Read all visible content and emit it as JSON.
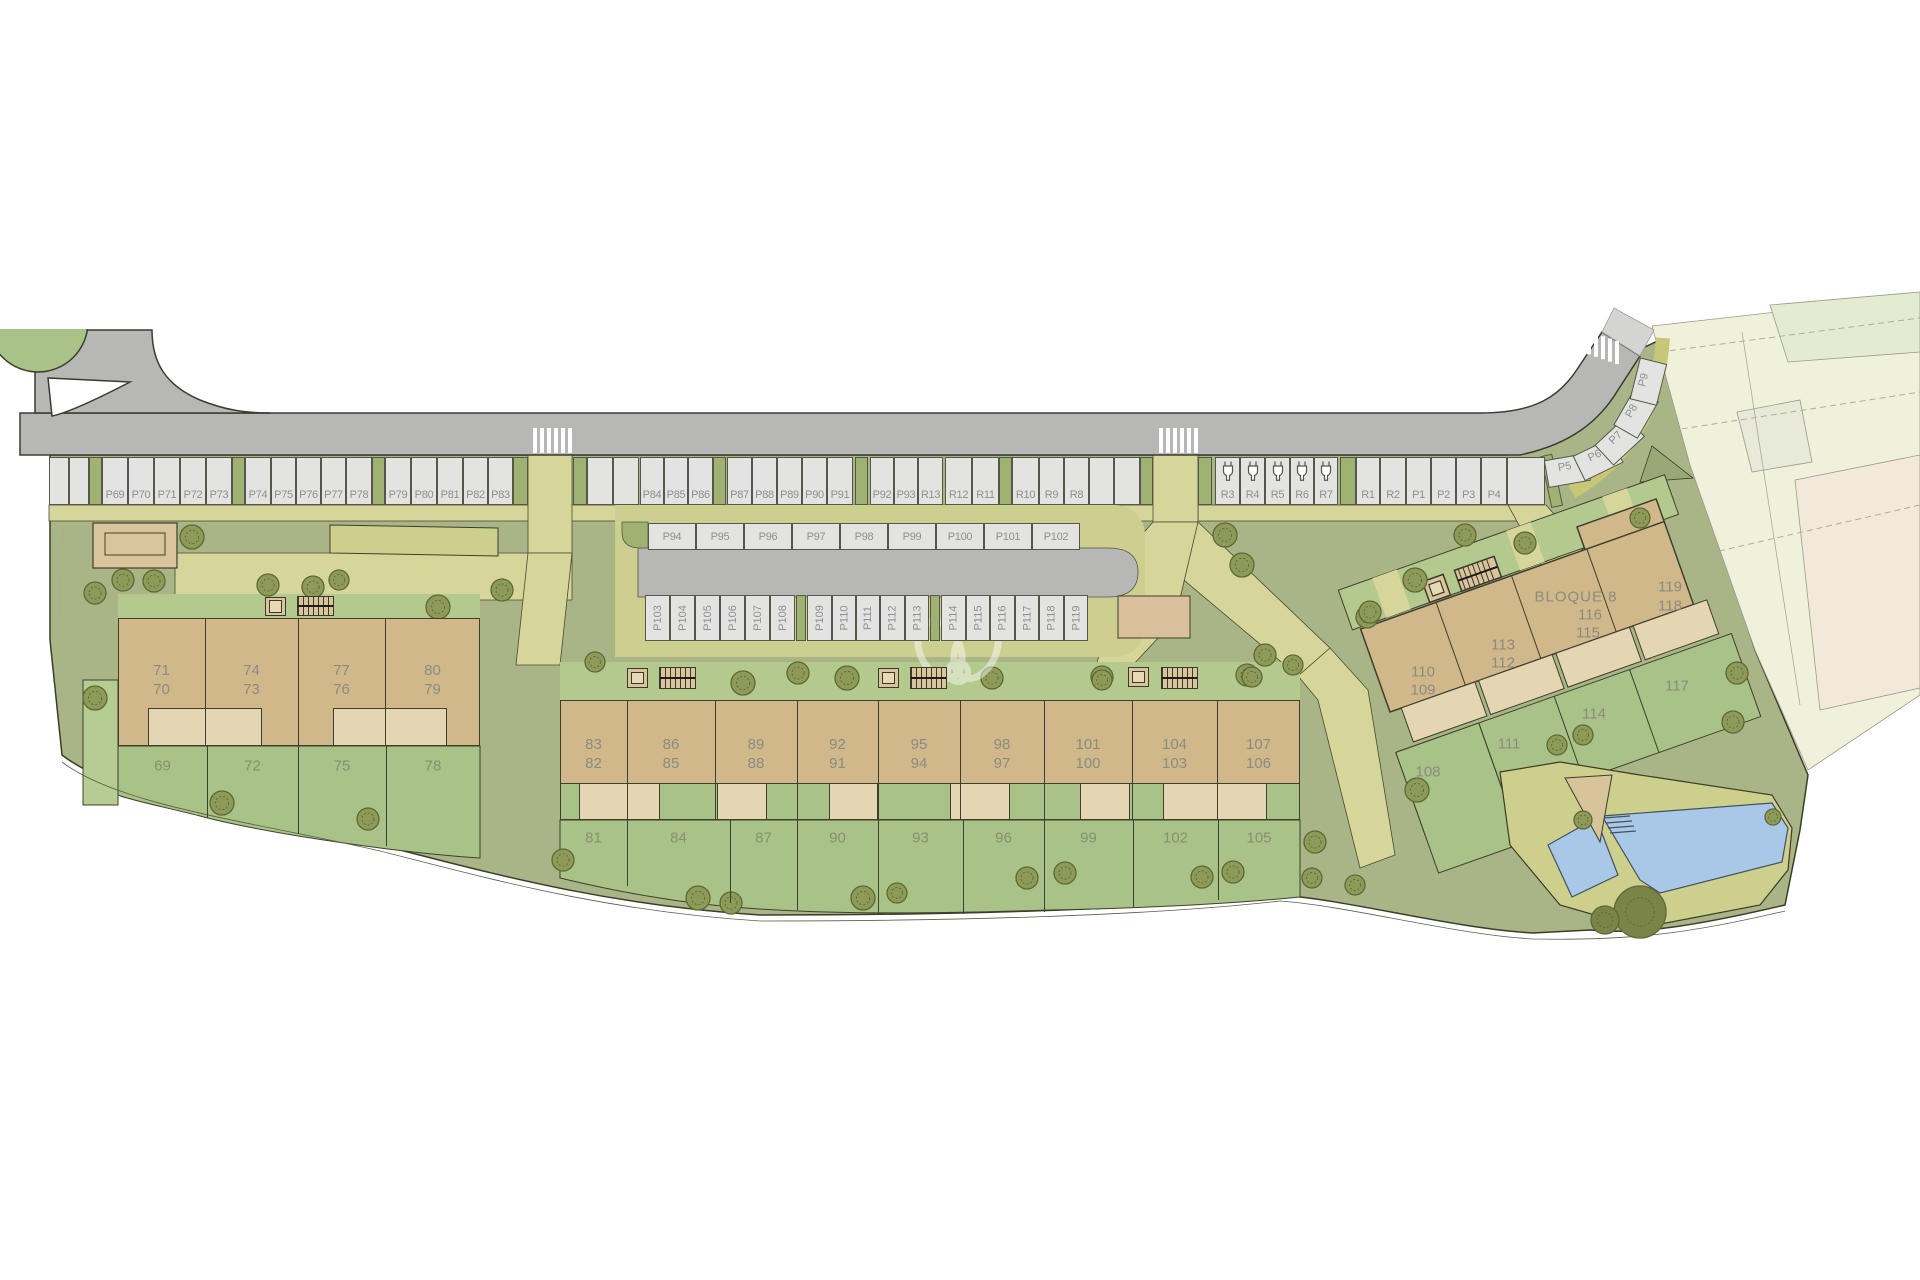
{
  "canvas": {
    "w": 1920,
    "h": 1280
  },
  "colors": {
    "road": "#b7b7b5",
    "stall": "#e3e3e1",
    "stall_border": "#56564a",
    "green_stall": "#9fb271",
    "verge": "#cdcf8c",
    "path": "#d6d69a",
    "lawn": "#a9b586",
    "garden": "#a8c287",
    "garden_light": "#b5cc92",
    "building_tan": "#d0b88b",
    "terrace_beige": "#e4d6b2",
    "pergola": "#d9c49c",
    "pool_water": "#a9c8e8",
    "cadastral": "#f0f1da",
    "cadastral_pink": "#f3e9da",
    "cadastral_green": "#e3ecd0",
    "tree_fill": "#8d9a58",
    "tree_stroke": "#5f6836",
    "outline": "#3f3f2e"
  },
  "parking": {
    "row1": {
      "y": 457,
      "h": 48,
      "segments": [
        {
          "t": "u",
          "x": 49,
          "w": 20
        },
        {
          "t": "u",
          "x": 69,
          "w": 20
        },
        {
          "t": "g",
          "x": 89,
          "w": 13
        },
        {
          "t": "s",
          "l": "P69",
          "x": 102,
          "w": 26
        },
        {
          "t": "s",
          "l": "P70",
          "x": 128,
          "w": 26
        },
        {
          "t": "s",
          "l": "P71",
          "x": 154,
          "w": 26
        },
        {
          "t": "s",
          "l": "P72",
          "x": 180,
          "w": 26
        },
        {
          "t": "s",
          "l": "P73",
          "x": 206,
          "w": 26
        },
        {
          "t": "g",
          "x": 232,
          "w": 13
        },
        {
          "t": "s",
          "l": "P74",
          "x": 245,
          "w": 26
        },
        {
          "t": "s",
          "l": "P75",
          "x": 271,
          "w": 25
        },
        {
          "t": "s",
          "l": "P76",
          "x": 296,
          "w": 25
        },
        {
          "t": "s",
          "l": "P77",
          "x": 321,
          "w": 25
        },
        {
          "t": "s",
          "l": "P78",
          "x": 346,
          "w": 26
        },
        {
          "t": "g",
          "x": 372,
          "w": 13
        },
        {
          "t": "s",
          "l": "P79",
          "x": 385,
          "w": 26
        },
        {
          "t": "s",
          "l": "P80",
          "x": 411,
          "w": 26
        },
        {
          "t": "s",
          "l": "P81",
          "x": 437,
          "w": 26
        },
        {
          "t": "s",
          "l": "P82",
          "x": 463,
          "w": 25
        },
        {
          "t": "s",
          "l": "P83",
          "x": 488,
          "w": 25
        },
        {
          "t": "g",
          "x": 513,
          "w": 15
        },
        {
          "t": "p",
          "x": 528,
          "w": 45
        },
        {
          "t": "g",
          "x": 573,
          "w": 14
        },
        {
          "t": "u",
          "x": 587,
          "w": 26
        },
        {
          "t": "u",
          "x": 613,
          "w": 26
        },
        {
          "t": "s",
          "l": "P84",
          "x": 640,
          "w": 24
        },
        {
          "t": "s",
          "l": "P85",
          "x": 664,
          "w": 24
        },
        {
          "t": "s",
          "l": "P86",
          "x": 688,
          "w": 25
        },
        {
          "t": "g",
          "x": 713,
          "w": 13
        },
        {
          "t": "s",
          "l": "P87",
          "x": 727,
          "w": 25
        },
        {
          "t": "s",
          "l": "P88",
          "x": 752,
          "w": 25
        },
        {
          "t": "s",
          "l": "P89",
          "x": 777,
          "w": 25
        },
        {
          "t": "s",
          "l": "P90",
          "x": 802,
          "w": 25
        },
        {
          "t": "s",
          "l": "P91",
          "x": 827,
          "w": 26
        },
        {
          "t": "g",
          "x": 855,
          "w": 13
        },
        {
          "t": "s",
          "l": "P92",
          "x": 870,
          "w": 24
        },
        {
          "t": "s",
          "l": "P93",
          "x": 894,
          "w": 24
        },
        {
          "t": "s",
          "l": "R13",
          "x": 918,
          "w": 25
        },
        {
          "t": "s",
          "l": "R12",
          "x": 945,
          "w": 27
        },
        {
          "t": "s",
          "l": "R11",
          "x": 972,
          "w": 27
        },
        {
          "t": "g",
          "x": 999,
          "w": 13
        },
        {
          "t": "s",
          "l": "R10",
          "x": 1012,
          "w": 27
        },
        {
          "t": "s",
          "l": "R9",
          "x": 1039,
          "w": 25
        },
        {
          "t": "s",
          "l": "R8",
          "x": 1064,
          "w": 25
        },
        {
          "t": "u",
          "x": 1089,
          "w": 25
        },
        {
          "t": "u",
          "x": 1114,
          "w": 26
        },
        {
          "t": "g",
          "x": 1140,
          "w": 13
        },
        {
          "t": "p",
          "x": 1153,
          "w": 45
        },
        {
          "t": "g",
          "x": 1198,
          "w": 14
        },
        {
          "t": "c",
          "l": "R3",
          "x": 1215,
          "w": 25
        },
        {
          "t": "c",
          "l": "R4",
          "x": 1240,
          "w": 25
        },
        {
          "t": "c",
          "l": "R5",
          "x": 1265,
          "w": 25
        },
        {
          "t": "c",
          "l": "R6",
          "x": 1290,
          "w": 24
        },
        {
          "t": "c",
          "l": "R7",
          "x": 1314,
          "w": 24
        },
        {
          "t": "g",
          "x": 1340,
          "w": 16
        },
        {
          "t": "s",
          "l": "R1",
          "x": 1356,
          "w": 24
        },
        {
          "t": "s",
          "l": "R2",
          "x": 1380,
          "w": 26
        },
        {
          "t": "s",
          "l": "P1",
          "x": 1406,
          "w": 25
        },
        {
          "t": "s",
          "l": "P2",
          "x": 1431,
          "w": 25
        },
        {
          "t": "s",
          "l": "P3",
          "x": 1456,
          "w": 25
        },
        {
          "t": "s",
          "l": "P4",
          "x": 1481,
          "w": 26
        },
        {
          "t": "u",
          "x": 1507,
          "w": 38
        }
      ]
    },
    "row2": {
      "y": 523,
      "h": 27,
      "stalls": [
        {
          "l": "P94",
          "x": 648,
          "w": 48
        },
        {
          "l": "P95",
          "x": 696,
          "w": 48
        },
        {
          "l": "P96",
          "x": 744,
          "w": 48
        },
        {
          "l": "P97",
          "x": 792,
          "w": 48
        },
        {
          "l": "P98",
          "x": 840,
          "w": 48
        },
        {
          "l": "P99",
          "x": 888,
          "w": 48
        },
        {
          "l": "P100",
          "x": 936,
          "w": 48
        },
        {
          "l": "P101",
          "x": 984,
          "w": 48
        },
        {
          "l": "P102",
          "x": 1032,
          "w": 48
        }
      ]
    },
    "row3": {
      "y": 595,
      "h": 46,
      "segments": [
        {
          "t": "s",
          "l": "P103",
          "x": 645,
          "w": 25
        },
        {
          "t": "s",
          "l": "P104",
          "x": 670,
          "w": 25
        },
        {
          "t": "s",
          "l": "P105",
          "x": 695,
          "w": 25
        },
        {
          "t": "s",
          "l": "P106",
          "x": 720,
          "w": 25
        },
        {
          "t": "s",
          "l": "P107",
          "x": 745,
          "w": 25
        },
        {
          "t": "s",
          "l": "P108",
          "x": 770,
          "w": 25
        },
        {
          "t": "g",
          "x": 796,
          "w": 10
        },
        {
          "t": "s",
          "l": "P109",
          "x": 807,
          "w": 25
        },
        {
          "t": "s",
          "l": "P110",
          "x": 832,
          "w": 24
        },
        {
          "t": "s",
          "l": "P111",
          "x": 856,
          "w": 24
        },
        {
          "t": "s",
          "l": "P112",
          "x": 880,
          "w": 25
        },
        {
          "t": "s",
          "l": "P113",
          "x": 905,
          "w": 24
        },
        {
          "t": "g",
          "x": 930,
          "w": 10
        },
        {
          "t": "s",
          "l": "P114",
          "x": 941,
          "w": 25
        },
        {
          "t": "s",
          "l": "P115",
          "x": 966,
          "w": 24
        },
        {
          "t": "s",
          "l": "P116",
          "x": 990,
          "w": 25
        },
        {
          "t": "s",
          "l": "P117",
          "x": 1015,
          "w": 24
        },
        {
          "t": "s",
          "l": "P118",
          "x": 1039,
          "w": 25
        },
        {
          "t": "s",
          "l": "P119",
          "x": 1064,
          "w": 24
        }
      ]
    },
    "curve_stalls": [
      {
        "l": "P5",
        "x": 1567,
        "y": 468,
        "r": -10
      },
      {
        "l": "P6",
        "x": 1597,
        "y": 457,
        "r": -26
      },
      {
        "l": "P7",
        "x": 1618,
        "y": 439,
        "r": -43
      },
      {
        "l": "P8",
        "x": 1634,
        "y": 412,
        "r": -60
      },
      {
        "l": "P9",
        "x": 1646,
        "y": 381,
        "r": -76
      }
    ]
  },
  "blocks": {
    "bloque6": {
      "title": "BLOQUE 6",
      "title_pos": {
        "x": 298,
        "y": 643
      },
      "bounds": [
        118,
        205,
        298,
        385,
        480
      ],
      "y": {
        "top": 618,
        "terrace": 708,
        "bottom": 746
      },
      "units": [
        [
          "71",
          "70"
        ],
        [
          "74",
          "73"
        ],
        [
          "77",
          "76"
        ],
        [
          "80",
          "79"
        ]
      ],
      "unit_y": 680,
      "terraces": [
        [
          148,
          114
        ],
        [
          333,
          114
        ]
      ],
      "gardens": {
        "label_y": 766,
        "bounds": [
          118,
          207,
          298,
          386,
          480
        ],
        "labels": [
          "69",
          "72",
          "75",
          "78"
        ],
        "div_h": [
          72,
          88,
          100
        ]
      }
    },
    "bloque7": {
      "title": "BLOQUE 7",
      "title_pos": {
        "x": 952,
        "y": 721
      },
      "bounds": [
        560,
        627,
        715,
        797,
        878,
        960,
        1044,
        1132,
        1217,
        1300
      ],
      "y": {
        "top": 700,
        "terrace": 783,
        "bottom": 820
      },
      "units": [
        [
          "83",
          "82"
        ],
        [
          "86",
          "85"
        ],
        [
          "89",
          "88"
        ],
        [
          "92",
          "91"
        ],
        [
          "95",
          "94"
        ],
        [
          "98",
          "97"
        ],
        [
          "101",
          "100"
        ],
        [
          "104",
          "103"
        ],
        [
          "107",
          "106"
        ]
      ],
      "unit_y": 754,
      "terraces": [
        [
          579,
          81
        ],
        [
          717,
          50
        ],
        [
          829,
          49
        ],
        [
          950,
          60
        ],
        [
          1080,
          50
        ],
        [
          1163,
          104
        ]
      ],
      "gardens": {
        "label_y": 838,
        "bounds": [
          560,
          627,
          730,
          797,
          878,
          963,
          1044,
          1133,
          1218,
          1300
        ],
        "labels": [
          "81",
          "84",
          "87",
          "90",
          "93",
          "96",
          "99",
          "102",
          "105"
        ],
        "div_h": [
          66,
          83,
          90,
          93,
          94,
          92,
          87,
          80
        ]
      }
    },
    "bloque8": {
      "title": "BLOQUE 8",
      "labels": [
        {
          "t": "BLOQUE 8",
          "x": 1576,
          "y": 597,
          "title": true
        },
        {
          "t": "116",
          "x": 1590,
          "y": 615
        },
        {
          "t": "115",
          "x": 1588,
          "y": 633
        },
        {
          "t": "119",
          "x": 1670,
          "y": 587
        },
        {
          "t": "118",
          "x": 1670,
          "y": 606
        },
        {
          "t": "113",
          "x": 1503,
          "y": 645
        },
        {
          "t": "112",
          "x": 1503,
          "y": 663
        },
        {
          "t": "110",
          "x": 1423,
          "y": 672
        },
        {
          "t": "109",
          "x": 1423,
          "y": 690
        },
        {
          "t": "117",
          "x": 1677,
          "y": 686
        },
        {
          "t": "114",
          "x": 1594,
          "y": 714
        },
        {
          "t": "111",
          "x": 1509,
          "y": 744
        },
        {
          "t": "108",
          "x": 1428,
          "y": 772
        }
      ]
    }
  },
  "icons": {
    "elevators": [
      {
        "x": 265,
        "y": 597,
        "w": 21,
        "h": 19
      },
      {
        "x": 627,
        "y": 668,
        "w": 21,
        "h": 20
      },
      {
        "x": 878,
        "y": 668,
        "w": 21,
        "h": 20
      },
      {
        "x": 1128,
        "y": 667,
        "w": 21,
        "h": 20
      }
    ],
    "stairs": [
      {
        "x": 297,
        "y": 596,
        "w": 37,
        "h": 20
      },
      {
        "x": 659,
        "y": 667,
        "w": 37,
        "h": 22
      },
      {
        "x": 910,
        "y": 667,
        "w": 37,
        "h": 22
      },
      {
        "x": 1161,
        "y": 667,
        "w": 37,
        "h": 22
      }
    ]
  },
  "crosswalks": [
    {
      "x": 533,
      "y": 428,
      "n": 6,
      "dy": 0,
      "h": 25
    },
    {
      "x": 1159,
      "y": 428,
      "n": 6,
      "dy": 0,
      "h": 25
    },
    {
      "x": 1580,
      "y": 329,
      "n": 6,
      "dy": 2.4,
      "h": 23
    }
  ],
  "trees": [
    [
      95,
      593,
      11
    ],
    [
      123,
      580,
      11
    ],
    [
      154,
      581,
      11
    ],
    [
      192,
      537,
      12
    ],
    [
      268,
      585,
      11
    ],
    [
      313,
      587,
      11
    ],
    [
      339,
      580,
      10
    ],
    [
      438,
      607,
      12
    ],
    [
      502,
      590,
      11
    ],
    [
      95,
      698,
      12
    ],
    [
      222,
      803,
      12
    ],
    [
      368,
      819,
      11
    ],
    [
      466,
      476,
      14,
      1
    ],
    [
      595,
      662,
      10
    ],
    [
      743,
      683,
      12
    ],
    [
      798,
      673,
      11
    ],
    [
      847,
      678,
      12
    ],
    [
      992,
      678,
      11
    ],
    [
      1102,
      677,
      11
    ],
    [
      1247,
      675,
      11
    ],
    [
      1293,
      665,
      10
    ],
    [
      563,
      860,
      11
    ],
    [
      698,
      898,
      12
    ],
    [
      731,
      903,
      11
    ],
    [
      863,
      898,
      12
    ],
    [
      897,
      893,
      10
    ],
    [
      1027,
      878,
      11
    ],
    [
      1065,
      873,
      11
    ],
    [
      1202,
      877,
      11
    ],
    [
      1233,
      872,
      11
    ],
    [
      1315,
      842,
      11
    ],
    [
      1312,
      878,
      10
    ],
    [
      1355,
      885,
      10
    ],
    [
      1225,
      535,
      12
    ],
    [
      1242,
      565,
      12
    ],
    [
      1367,
      617,
      11
    ],
    [
      1265,
      655,
      11
    ],
    [
      1252,
      677,
      10
    ],
    [
      1102,
      680,
      10
    ],
    [
      1465,
      535,
      11
    ],
    [
      1525,
      543,
      11
    ],
    [
      1415,
      580,
      12
    ],
    [
      1370,
      612,
      11
    ],
    [
      1640,
      518,
      10
    ],
    [
      1737,
      673,
      11
    ],
    [
      1733,
      722,
      11
    ],
    [
      1583,
      735,
      10
    ],
    [
      1557,
      745,
      10
    ],
    [
      1417,
      790,
      12
    ],
    [
      1773,
      817,
      8
    ],
    [
      1583,
      820,
      9
    ],
    [
      1640,
      912,
      26,
      1
    ],
    [
      1605,
      920,
      14,
      1
    ]
  ],
  "watermark": {
    "present": true
  }
}
